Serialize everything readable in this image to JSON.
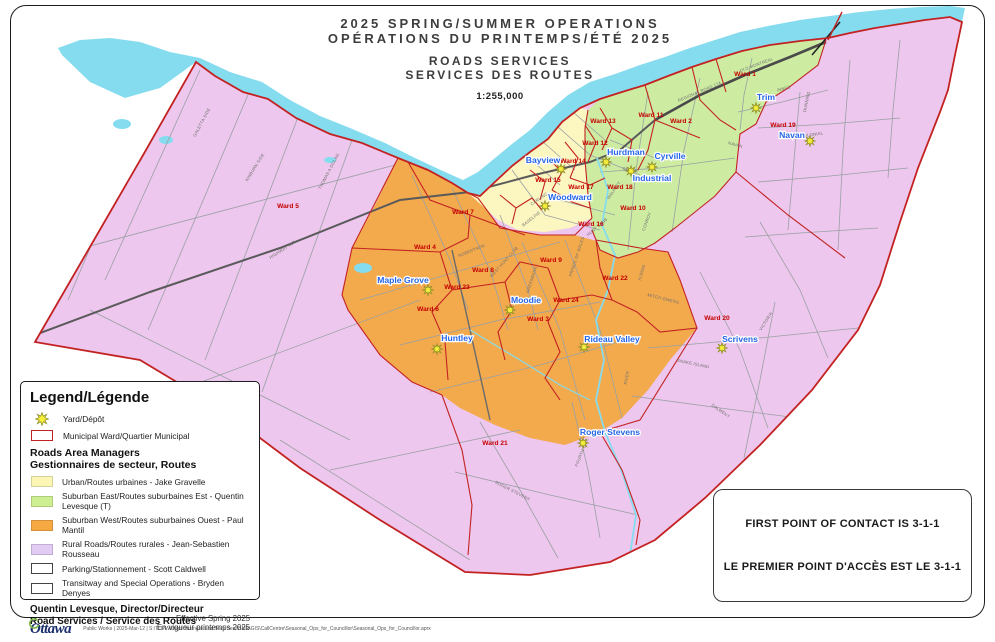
{
  "title": {
    "line1": "2025 SPRING/SUMMER OPERATIONS",
    "line2": "OPÉRATIONS DU PRINTEMPS/ÉTÉ 2025",
    "line3": "ROADS SERVICES",
    "line4": "SERVICES DES ROUTES",
    "scale": "1:255,000"
  },
  "legend": {
    "title": "Legend/Légende",
    "yard_label": "Yard/Dépôt",
    "ward_label": "Municipal Ward/Quartier Municipal",
    "managers": {
      "subtitle_line1": "Roads Area Managers",
      "subtitle_line2": "Gestionnaires de secteur, Routes",
      "items": [
        {
          "label": "Urban/Routes urbaines - Jake Gravelle",
          "color": "#fbf6b4",
          "border": false
        },
        {
          "label": "Suburban East/Routes suburbaines Est - Quentin Levesque (T)",
          "color": "#cdef92",
          "border": false
        },
        {
          "label": "Suburban West/Routes suburbaines Ouest - Paul Mantil",
          "color": "#f6a843",
          "border": false
        },
        {
          "label": "Rural Roads/Routes rurales - Jean-Sebastien Rousseau",
          "color": "#e3ccf4",
          "border": false
        },
        {
          "label": "Parking/Stationnement - Scott Caldwell",
          "color": "#ffffff",
          "border": true
        },
        {
          "label": "Transitway and Special Operations - Bryden Denyes",
          "color": "#ffffff",
          "border": true
        }
      ]
    },
    "director_line1": "Quentin Levesque, Director/Directeur",
    "director_line2": "Road Services / Service des Routes",
    "effective_line1": "Effective Spring 2025",
    "effective_line2": "En vigueur printemps 2025"
  },
  "contact": {
    "line1": "FIRST POINT OF CONTACT IS 3-1-1",
    "line2": "LE PREMIER POINT D'ACCÈS EST LE 3-1-1"
  },
  "footer": {
    "logo": "Ottawa",
    "path": "Public Works | 2025-Mar-12 | S:\\TUPW\\Dept Business and Tech Serv\\BMR\\GIS\\CallCentre\\Seasonal_Ops_for_Councillor\\Seasonal_Ops_for_Councillor.aprx"
  },
  "map": {
    "colors": {
      "urban": "#fcf6c0",
      "suburban_east": "#cdeca2",
      "suburban_west": "#f3aa4d",
      "rural": "#edc7ed",
      "water": "#85dcee",
      "ward_boundary": "#c32222",
      "ward_label": "#c40000",
      "depot_label": "#2465e8",
      "depot_star": "#f8ef3a"
    },
    "ward_labels": [
      {
        "label": "Ward 1",
        "x": 745,
        "y": 76
      },
      {
        "label": "Ward 2",
        "x": 681,
        "y": 123
      },
      {
        "label": "Ward 3",
        "x": 538,
        "y": 321
      },
      {
        "label": "Ward 4",
        "x": 425,
        "y": 249
      },
      {
        "label": "Ward 5",
        "x": 288,
        "y": 208
      },
      {
        "label": "Ward 6",
        "x": 428,
        "y": 311
      },
      {
        "label": "Ward 7",
        "x": 463,
        "y": 214
      },
      {
        "label": "Ward 8",
        "x": 483,
        "y": 272
      },
      {
        "label": "Ward 9",
        "x": 551,
        "y": 262
      },
      {
        "label": "Ward 10",
        "x": 633,
        "y": 210
      },
      {
        "label": "Ward 11",
        "x": 651,
        "y": 117
      },
      {
        "label": "Ward 12",
        "x": 595,
        "y": 145
      },
      {
        "label": "Ward 13",
        "x": 603,
        "y": 123
      },
      {
        "label": "Ward 14",
        "x": 573,
        "y": 163
      },
      {
        "label": "Ward 15",
        "x": 548,
        "y": 182
      },
      {
        "label": "Ward 16",
        "x": 591,
        "y": 226
      },
      {
        "label": "Ward 17",
        "x": 581,
        "y": 189
      },
      {
        "label": "Ward 18",
        "x": 620,
        "y": 189
      },
      {
        "label": "Ward 19",
        "x": 783,
        "y": 127
      },
      {
        "label": "Ward 20",
        "x": 717,
        "y": 320
      },
      {
        "label": "Ward 21",
        "x": 495,
        "y": 445
      },
      {
        "label": "Ward 22",
        "x": 615,
        "y": 280
      },
      {
        "label": "Ward 23",
        "x": 457,
        "y": 289
      },
      {
        "label": "Ward 24",
        "x": 566,
        "y": 302
      }
    ],
    "depots": [
      {
        "name": "Bayview",
        "label_x": 543,
        "label_y": 163,
        "star_x": 561,
        "star_y": 169
      },
      {
        "name": "Hurdman",
        "label_x": 626,
        "label_y": 155,
        "star_x": 606,
        "star_y": 162
      },
      {
        "name": "Cyrville",
        "label_x": 670,
        "label_y": 159,
        "star_x": 652,
        "star_y": 167
      },
      {
        "name": "Industrial",
        "label_x": 652,
        "label_y": 181,
        "star_x": 631,
        "star_y": 171
      },
      {
        "name": "Woodward",
        "label_x": 570,
        "label_y": 200,
        "star_x": 545,
        "star_y": 206
      },
      {
        "name": "Maple Grove",
        "label_x": 403,
        "label_y": 283,
        "star_x": 428,
        "star_y": 290
      },
      {
        "name": "Moodie",
        "label_x": 526,
        "label_y": 303,
        "star_x": 510,
        "star_y": 310
      },
      {
        "name": "Huntley",
        "label_x": 457,
        "label_y": 341,
        "star_x": 437,
        "star_y": 349
      },
      {
        "name": "Rideau Valley",
        "label_x": 612,
        "label_y": 342,
        "star_x": 584,
        "star_y": 347
      },
      {
        "name": "Scrivens",
        "label_x": 740,
        "label_y": 342,
        "star_x": 722,
        "star_y": 348
      },
      {
        "name": "Roger Stevens",
        "label_x": 610,
        "label_y": 435,
        "star_x": 583,
        "star_y": 443
      },
      {
        "name": "Navan",
        "label_x": 792,
        "label_y": 138,
        "star_x": 810,
        "star_y": 141
      },
      {
        "name": "Trim",
        "label_x": 766,
        "label_y": 100,
        "star_x": 756,
        "star_y": 108
      }
    ],
    "road_labels": [
      {
        "text": "GALETTA SIDE",
        "x": 203,
        "y": 123,
        "rot": -62
      },
      {
        "text": "KINBURN SIDE",
        "x": 256,
        "y": 168,
        "rot": -58
      },
      {
        "text": "THOMAS A DOLAN",
        "x": 330,
        "y": 172,
        "rot": -62
      },
      {
        "text": "HIGHWAY 417",
        "x": 283,
        "y": 251,
        "rot": -33
      },
      {
        "text": "OLD MONTREAL",
        "x": 757,
        "y": 66,
        "rot": -20
      },
      {
        "text": "REGIONAL ROAD 174",
        "x": 700,
        "y": 93,
        "rot": -23
      },
      {
        "text": "INNES",
        "x": 784,
        "y": 90,
        "rot": -14
      },
      {
        "text": "DUNNING",
        "x": 808,
        "y": 102,
        "rot": -78
      },
      {
        "text": "COLONIAL",
        "x": 812,
        "y": 136,
        "rot": -8
      },
      {
        "text": "NAVAN",
        "x": 735,
        "y": 146,
        "rot": 16
      },
      {
        "text": "SMYTH",
        "x": 630,
        "y": 171,
        "rot": 8
      },
      {
        "text": "WALKLEY",
        "x": 615,
        "y": 191,
        "rot": -55
      },
      {
        "text": "CONROY",
        "x": 648,
        "y": 222,
        "rot": -70
      },
      {
        "text": "BASELINE",
        "x": 532,
        "y": 220,
        "rot": -38
      },
      {
        "text": "CARLING",
        "x": 540,
        "y": 200,
        "rot": -35
      },
      {
        "text": "ROBERTSON",
        "x": 472,
        "y": 252,
        "rot": -22
      },
      {
        "text": "WEST HUNT CLUB",
        "x": 505,
        "y": 263,
        "rot": -48
      },
      {
        "text": "GREENBANK",
        "x": 533,
        "y": 280,
        "rot": -72
      },
      {
        "text": "PRINCE OF WALES",
        "x": 578,
        "y": 257,
        "rot": -72
      },
      {
        "text": "HUNT CLUB",
        "x": 598,
        "y": 228,
        "rot": -40
      },
      {
        "text": "ALBION",
        "x": 643,
        "y": 273,
        "rot": -72
      },
      {
        "text": "RIVER",
        "x": 628,
        "y": 378,
        "rot": -80
      },
      {
        "text": "MITCH OWENS",
        "x": 663,
        "y": 300,
        "rot": 14
      },
      {
        "text": "SNAKE ISLAND",
        "x": 693,
        "y": 365,
        "rot": 12
      },
      {
        "text": "DALMENY",
        "x": 720,
        "y": 412,
        "rot": 35
      },
      {
        "text": "VICTORIA",
        "x": 767,
        "y": 322,
        "rot": -58
      },
      {
        "text": "ROGER STEVENS",
        "x": 512,
        "y": 492,
        "rot": 27
      },
      {
        "text": "FOURTH LINE",
        "x": 583,
        "y": 453,
        "rot": -68
      }
    ]
  }
}
